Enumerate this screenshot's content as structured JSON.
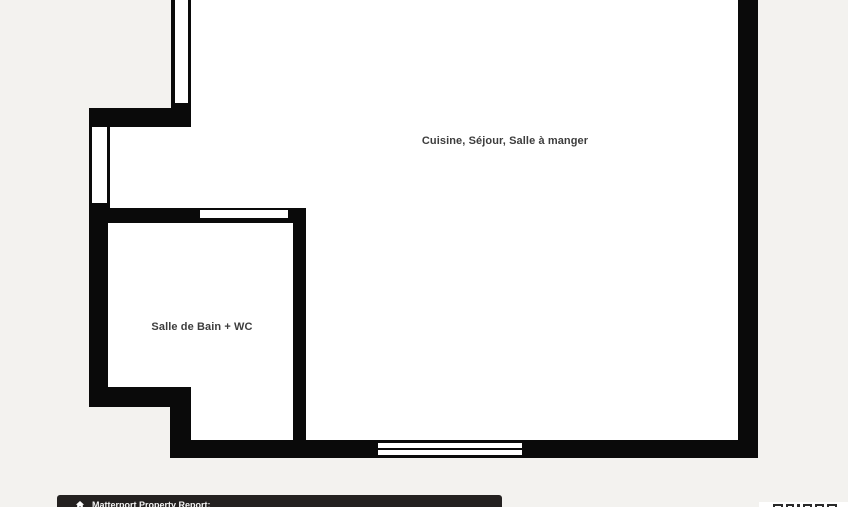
{
  "app": {
    "name": "Matterport floor plan"
  },
  "floor_plan": {
    "rooms": [
      {
        "name": "Cuisine, Séjour, Salle à manger"
      },
      {
        "name": "Salle de Bain + WC"
      }
    ],
    "features": [
      "window-top-left-wall",
      "window-left-wall",
      "window-bathroom-partition",
      "window-bottom-wall"
    ]
  },
  "footer": {
    "icon": "house-icon",
    "title": "Matterport Property Report:"
  },
  "bottom_right": {
    "note": "white box with clipped logo glyph tops"
  },
  "colors": {
    "bg": "#f3f2ef",
    "wall": "#0a0a0a",
    "floor": "#ffffff",
    "label": "#3d3d3d",
    "bar-bg": "#242120",
    "bar-text": "#f4f4f4"
  }
}
